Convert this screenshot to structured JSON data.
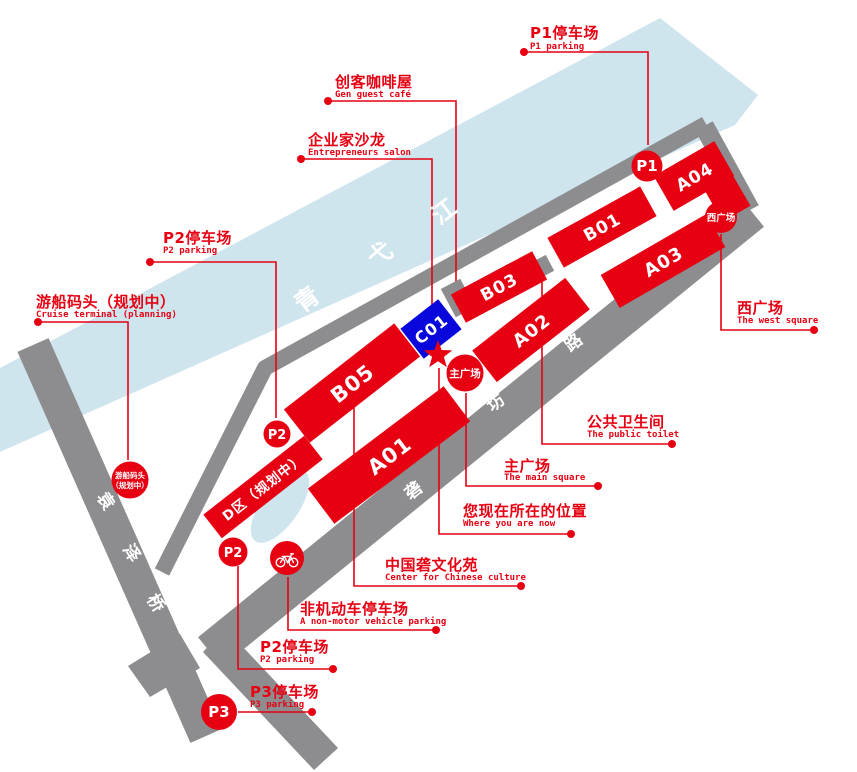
{
  "colors": {
    "accent_red": "#e60012",
    "river_blue": "#cfe5ee",
    "road_gray": "#8d8d90",
    "building_blue": "#0808dc",
    "text_white": "#ffffff"
  },
  "river": {
    "name_chars": [
      "青",
      "弋",
      "江"
    ]
  },
  "roads": {
    "yuanze_bridge_chars": [
      "袁",
      "泽",
      "桥"
    ],
    "longfang_road_chars": [
      "砻",
      "坊",
      "路"
    ]
  },
  "buildings": [
    {
      "id": "b05",
      "label": "B05"
    },
    {
      "id": "a01",
      "label": "A01"
    },
    {
      "id": "c01",
      "label": "C01"
    },
    {
      "id": "b03",
      "label": "B03"
    },
    {
      "id": "b01",
      "label": "B01"
    },
    {
      "id": "a02",
      "label": "A02"
    },
    {
      "id": "a03",
      "label": "A03"
    },
    {
      "id": "a04",
      "label": "A04"
    },
    {
      "id": "d_zone",
      "label": "D区（规划中）"
    }
  ],
  "markers": {
    "p1": "P1",
    "p2_upper": "P2",
    "p2_lower": "P2",
    "p3": "P3",
    "west_square_circle": "西广场",
    "main_square_circle": "主广场",
    "cruise_circle_line1": "游船码头",
    "cruise_circle_line2": "（规划中）"
  },
  "icons": {
    "bicycle": "bicycle-icon",
    "you_are_here_star": "star-icon"
  },
  "labels": {
    "p1_parking": {
      "zh": "P1停车场",
      "en": "P1 parking"
    },
    "maker_cafe": {
      "zh": "创客咖啡屋",
      "en": "Gen guest café"
    },
    "entrepreneurs_salon": {
      "zh": "企业家沙龙",
      "en": "Entrepreneurs salon"
    },
    "p2_parking_upper": {
      "zh": "P2停车场",
      "en": "P2 parking"
    },
    "cruise_terminal": {
      "zh": "游船码头（规划中）",
      "en": "Cruise terminal (planning)"
    },
    "west_square": {
      "zh": "西广场",
      "en": "The west square"
    },
    "public_toilet": {
      "zh": "公共卫生间",
      "en": "The public toilet"
    },
    "main_square": {
      "zh": "主广场",
      "en": "The main square"
    },
    "you_are_here": {
      "zh": "您现在所在的位置",
      "en": "Where you are now"
    },
    "culture_center": {
      "zh": "中国砻文化苑",
      "en": "Center for Chinese culture"
    },
    "nonmotor_parking": {
      "zh": "非机动车停车场",
      "en": "A non-motor vehicle parking"
    },
    "p2_parking_lower": {
      "zh": "P2停车场",
      "en": "P2 parking"
    },
    "p3_parking": {
      "zh": "P3停车场",
      "en": "P3 parking"
    }
  }
}
